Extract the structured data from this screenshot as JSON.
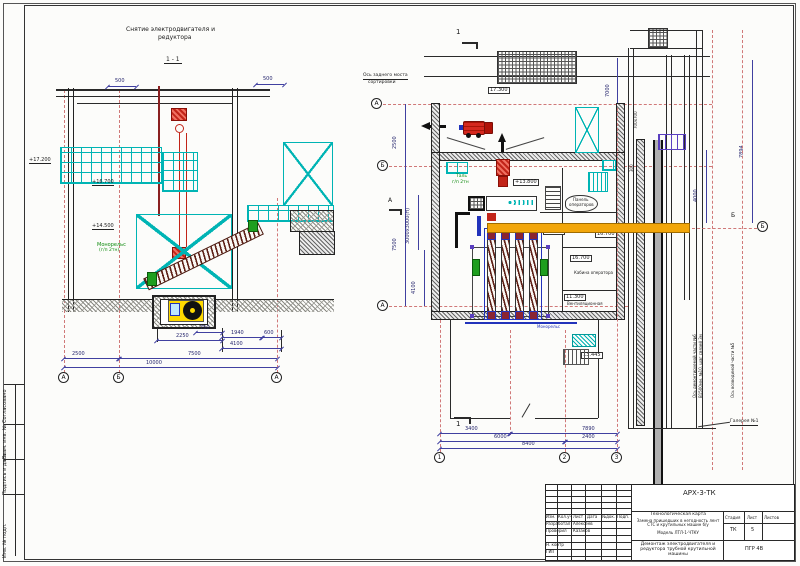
{
  "sheet": {
    "margin_stamp": {
      "agreed": "Согласовано",
      "replace_inv": "Взам. инв. №",
      "sign_date": "Подпись и дата",
      "inv_orig": "Инв. № подл."
    },
    "colors": {
      "scaffold_cyan": "#00b4b4",
      "hoist_red": "#c22418",
      "monorail_orange": "#f2a60a",
      "motor_yellow": "#ffd900",
      "note_green": "#0d8a0d",
      "frame_blue": "#2233bb",
      "axis_red": "#d07878",
      "screw_maroon": "#5e2016"
    }
  },
  "section_view": {
    "title_line1": "Снятие электродвигателя и",
    "title_line2": "редуктора",
    "section_label": "1 - 1",
    "levels": {
      "l17200": "+17.200",
      "l16700": "+16.700",
      "l14500": "+14.500"
    },
    "monorail_note": {
      "line1": "Монорельс",
      "line2": "(г/п 2тн)"
    },
    "dims": {
      "d500l": "500",
      "d500r": "500",
      "d750": "750",
      "d2250": "2250",
      "d1940": "1940",
      "d600": "600",
      "d4100": "4100",
      "d2500": "2500",
      "d7500": "7500",
      "d10000": "10000"
    },
    "axes": {
      "left": "А",
      "mid": "Б",
      "right": "А"
    }
  },
  "plan_view": {
    "section_marks": {
      "top": "1",
      "bottom": "1",
      "side": "А"
    },
    "crane_axis_note": {
      "line1": "Ось заднего моста",
      "line2": "сортировки"
    },
    "levels": {
      "l17300": "17.300",
      "l13800": "+13.800",
      "l14500": "14.500",
      "l16700_a": "16.700",
      "l16700_b": "16.700",
      "l11300": "11.300",
      "l13445": "13.445"
    },
    "rooms": {
      "panel_line1": "Панель",
      "panel_line2": "операторов",
      "operator": "Кабина оператора",
      "vent": "Вентиляционная"
    },
    "hoist_note": {
      "line1": "Таль",
      "line2": "г/п 2тн"
    },
    "monorail_label": "Монорельс",
    "dims_left": {
      "d2500": "2500",
      "d7500": "7500",
      "d3000": "3000х3000(Н)",
      "d4100": "4100"
    },
    "dims_bottom": {
      "d3400": "3400",
      "d6000": "6000",
      "d8400": "8400",
      "d7890": "7890",
      "d2400": "2400"
    },
    "dims_right": {
      "d7894": "7894",
      "d4000": "4000",
      "d300": "300",
      "d700": "700х700",
      "d7000": "7000"
    },
    "axes_left": {
      "a": "А",
      "b": "Б",
      "a2": "А"
    },
    "axes_bottom": {
      "n1": "1",
      "n2": "2",
      "n3": "3"
    },
    "axes_right": {
      "b_label": "Б",
      "b_bubble": "Б"
    },
    "notes": {
      "dismantle_1": "Ось демонтируемой части №6",
      "dismantle_2": "В1500мм, №10, шаг связей 3м",
      "erect": "Ось возводимой части №5",
      "gallery": "Галерея №1"
    }
  },
  "title_block": {
    "code": "АРХ-3-ТК",
    "columns": {
      "izm": "Изм.",
      "kol": "Кол.уч",
      "list": "Лист",
      "doc": "№док.",
      "sign": "Подп.",
      "date": "Дата"
    },
    "roles": {
      "developed": "Разработал",
      "checked": "Проверил",
      "ncontrol": "Н. контр",
      "gip": "ГИП"
    },
    "names": {
      "developed": "Алексеев",
      "checked": "Казаков"
    },
    "project": {
      "line1": "Технологическая карта",
      "line2": "Замена пришедших в негодность лент СТС и крутильных машин б/у",
      "line3": "Модель ЛТЛ-1-ЧТКУ"
    },
    "stage_table": {
      "stage_h": "Стадия",
      "sheet_h": "Лист",
      "sheets_h": "Листов",
      "stage": "ТК",
      "sheet": "5"
    },
    "subject": "Демонтаж электродвигателя и редуктора трубной крутильной машины",
    "doc_code": "ПГР 4В"
  }
}
